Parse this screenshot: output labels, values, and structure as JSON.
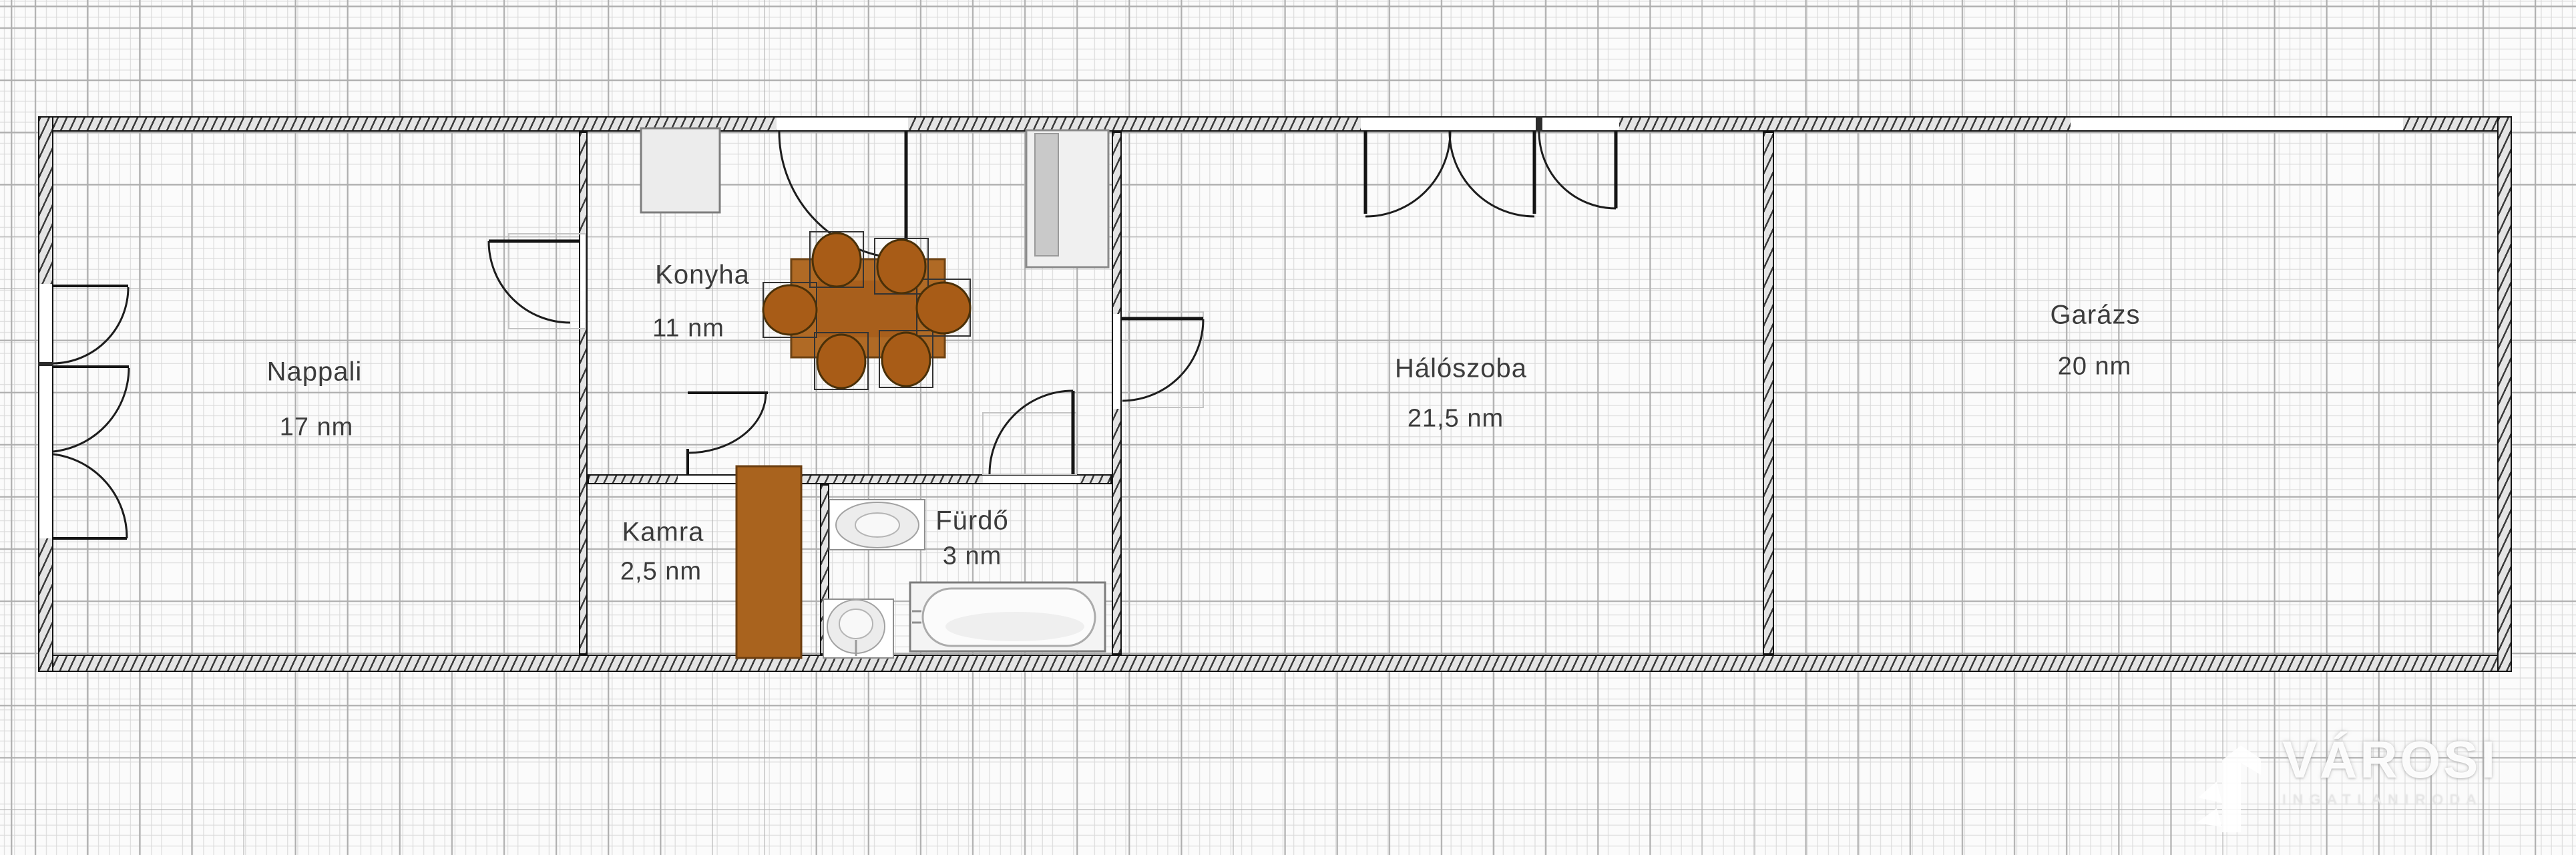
{
  "plan": {
    "rooms": [
      {
        "id": "nappali",
        "name": "Nappali",
        "area": "17 nm"
      },
      {
        "id": "konyha",
        "name": "Konyha",
        "area": "11 nm"
      },
      {
        "id": "kamra",
        "name": "Kamra",
        "area": "2,5 nm"
      },
      {
        "id": "furdo",
        "name": "Fürdő",
        "area": "3 nm"
      },
      {
        "id": "haloszoba",
        "name": "Hálószoba",
        "area": "21,5 nm"
      },
      {
        "id": "garazs",
        "name": "Garázs",
        "area": "20 nm"
      }
    ],
    "fixtures": [
      "dining-table",
      "chairs",
      "fridge-counter",
      "kitchen-cabinet",
      "pantry-cabinet",
      "sink",
      "toilet",
      "bathtub"
    ],
    "openings": [
      "entry-door-konyha",
      "door-nappali",
      "door-kamra",
      "door-furdo",
      "door-haloszoba",
      "window-nappali-left",
      "french-window-haloszoba",
      "window-haloszoba",
      "garage-door"
    ]
  },
  "watermark": {
    "brand": "VÁROSI",
    "tagline": "INGATLANIRODA"
  },
  "colors": {
    "wall_line": "#141414",
    "wall_fill": "#e4e4e4",
    "grid_minor": "#d9d9d9",
    "grid_major": "#aeaeae",
    "table_wood": "#b06a25",
    "chair_wood": "#a85c17",
    "cabinet_wood": "#a9631e",
    "label_text": "#3c3c3c"
  }
}
